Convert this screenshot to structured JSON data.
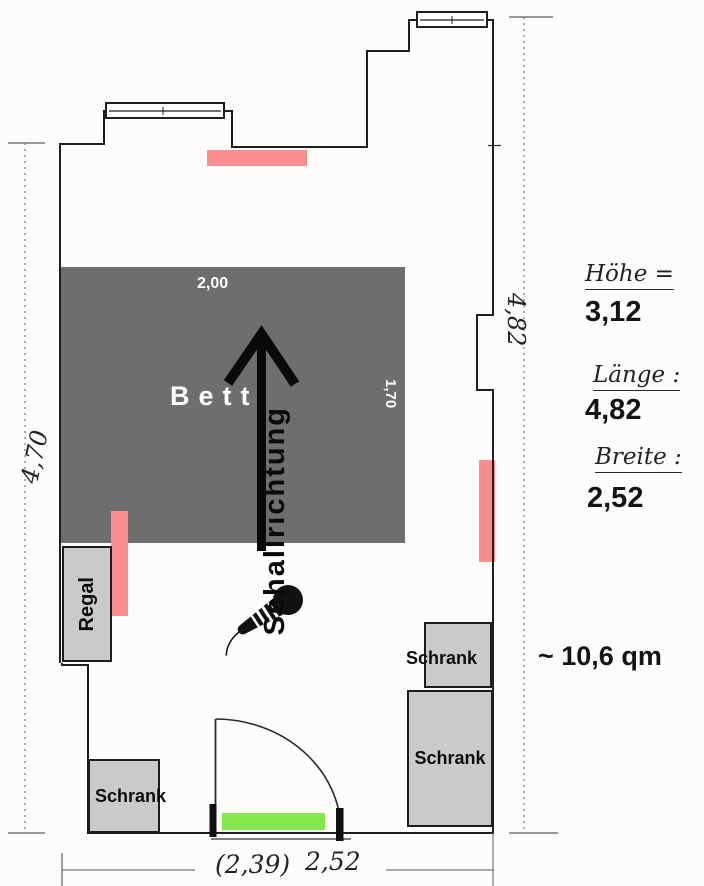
{
  "floorplan": {
    "bed": {
      "label": "Bett",
      "width_dim": "2,00",
      "length_dim": "1,70"
    },
    "shelf": {
      "label": "Regal"
    },
    "cabinets": {
      "bottom_left": {
        "label": "Schrank"
      },
      "right_upper": {
        "label": "Schrank"
      },
      "right_lower": {
        "label": "Schrank"
      }
    },
    "sound": {
      "direction_label": "Schallrichtung"
    },
    "dimensions": {
      "left_wall": "4,70",
      "right_wall": "4,82",
      "bottom_old": "(2,39)",
      "bottom": "2,52"
    },
    "annotations": {
      "height_label": "Höhe =",
      "height_value": "3,12",
      "length_label": "Länge :",
      "length_value": "4,82",
      "width_label": "Breite :",
      "width_value": "2,52",
      "area": "~ 10,6 qm"
    },
    "colors": {
      "bed_fill": "#6f6e6f",
      "furniture_fill": "#cacaca",
      "speaker_marker": "#fa8e8e",
      "door_mat": "#82e84e",
      "wall_line": "#1f1f1f"
    }
  }
}
